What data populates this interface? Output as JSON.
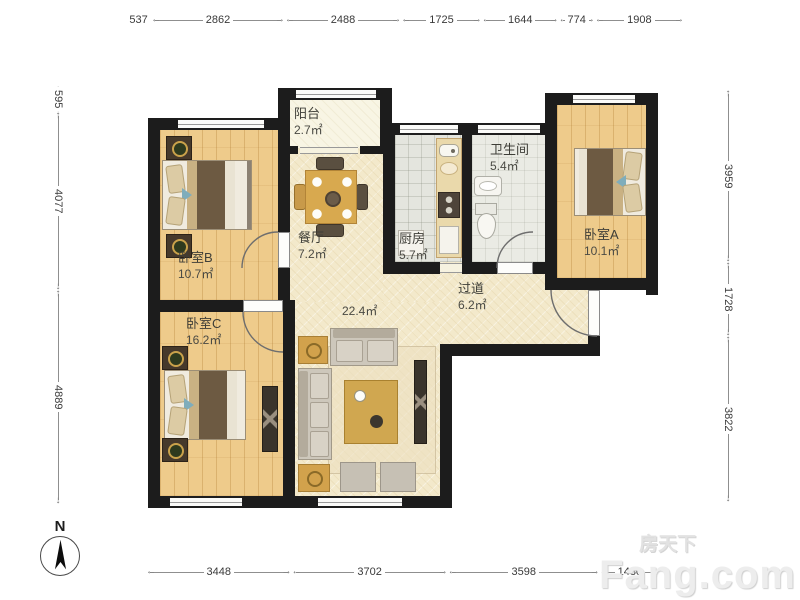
{
  "compass": {
    "label": "N"
  },
  "watermark": {
    "brand": "房天下",
    "domain": "Fang.com"
  },
  "dimensions": {
    "top": [
      "537",
      "2862",
      "2488",
      "1725",
      "1644",
      "774",
      "1908"
    ],
    "bottom": [
      "3448",
      "3702",
      "3598",
      "1430"
    ],
    "left": [
      "595",
      "4077",
      "4889"
    ],
    "right": [
      "3959",
      "1728",
      "3822"
    ]
  },
  "rooms": [
    {
      "id": "balcony",
      "name": "阳台",
      "area": "2.7㎡"
    },
    {
      "id": "bedroom-b",
      "name": "卧室B",
      "area": "10.7㎡"
    },
    {
      "id": "dining",
      "name": "餐厅",
      "area": "7.2㎡"
    },
    {
      "id": "kitchen",
      "name": "厨房",
      "area": "5.7㎡"
    },
    {
      "id": "bathroom",
      "name": "卫生间",
      "area": "5.4㎡"
    },
    {
      "id": "bedroom-a",
      "name": "卧室A",
      "area": "10.1㎡"
    },
    {
      "id": "hallway",
      "name": "过道",
      "area": "6.2㎡"
    },
    {
      "id": "living",
      "name": "",
      "area": "22.4㎡"
    },
    {
      "id": "bedroom-c",
      "name": "卧室C",
      "area": "16.2㎡"
    }
  ],
  "colors": {
    "wall": "#1c1c1c",
    "wood_floor": "#eecb8b",
    "open_floor": "#f3e9cb",
    "kitchen_tile": "#e4e5de",
    "bath_tile": "#eaebe4",
    "balcony_floor": "#f8f5e4",
    "accent_gold": "#d2a24c",
    "label_text": "#3e3e38"
  }
}
